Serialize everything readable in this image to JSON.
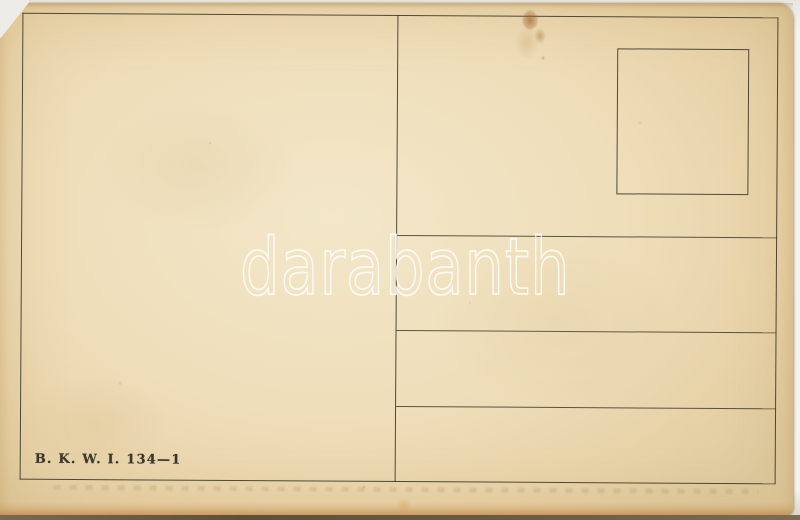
{
  "document": {
    "kind": "postcard-back-scan",
    "watermark_text": "darabanth",
    "imprint_text": "B. K. W. I. 134—1",
    "address_lines_count": 3,
    "regions": {
      "message_area": "left half, blank",
      "address_area": "right half with 3 ruled lines",
      "stamp_box": "upper right, empty square"
    },
    "colors": {
      "paper_center": "#f3e7c9",
      "paper_base": "#eeddb8",
      "paper_edge": "#decba0",
      "ink_line": "#3a3529",
      "stain_brown": "#94541e",
      "watermark_white": "#ffffff",
      "scan_background": "#f4f3ef",
      "bottom_edge_shadow": "#6e5c45"
    }
  }
}
